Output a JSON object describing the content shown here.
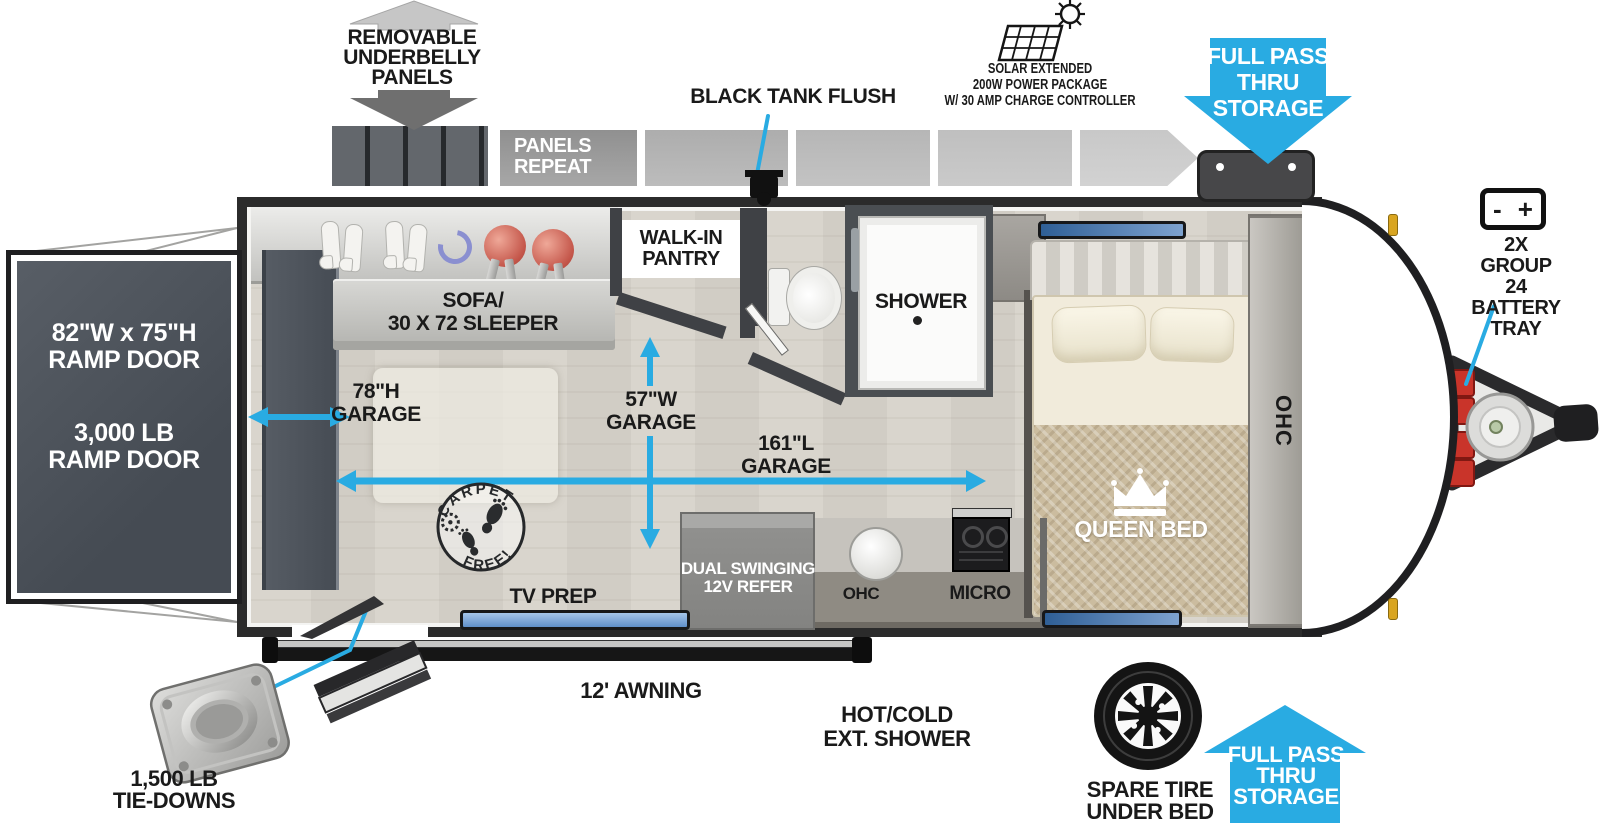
{
  "colors": {
    "accent": "#29abe2",
    "wall": "#3f4145",
    "floor": "#d6d2ca",
    "ramp_door": "#50565e"
  },
  "exterior_top": {
    "underbelly_label": "REMOVABLE\nUNDERBELLY\nPANELS",
    "panels_repeat": "PANELS\nREPEAT",
    "black_tank_flush": "BLACK TANK FLUSH",
    "solar_lines": [
      "SOLAR EXTENDED",
      "200W POWER PACKAGE",
      "W/ 30 AMP CHARGE CONTROLLER"
    ],
    "front_pass_thru": "FULL PASS\nTHRU\nSTORAGE",
    "battery_tray": "2X GROUP 24\nBATTERY\nTRAY",
    "battery_minus": "-",
    "battery_plus": "+"
  },
  "rear": {
    "ramp_size": "82\"W x 75\"H\nRAMP DOOR",
    "ramp_weight": "3,000 LB\nRAMP DOOR"
  },
  "interior": {
    "sofa": "SOFA/\n30 X 72 SLEEPER",
    "garage_height": "78\"H\nGARAGE",
    "garage_width": "57\"W\nGARAGE",
    "garage_length": "161\"L\nGARAGE",
    "pantry": "WALK-IN\nPANTRY",
    "shower": "SHOWER",
    "queen_bed": "QUEEN BED",
    "ohc_front": "OHC",
    "refer": "DUAL SWINGING\n12V REFER",
    "ohc_kitchen": "OHC",
    "micro": "MICRO",
    "tv_prep": "TV PREP",
    "carpet_stamp_top": "CARPET",
    "carpet_stamp_bottom": "FREE!"
  },
  "exterior_bottom": {
    "awning": "12' AWNING",
    "ext_shower": "HOT/COLD\nEXT. SHOWER",
    "spare_tire": "SPARE TIRE\nUNDER BED",
    "rear_pass_thru": "FULL PASS\nTHRU\nSTORAGE",
    "tie_downs": "1,500 LB\nTIE-DOWNS"
  }
}
